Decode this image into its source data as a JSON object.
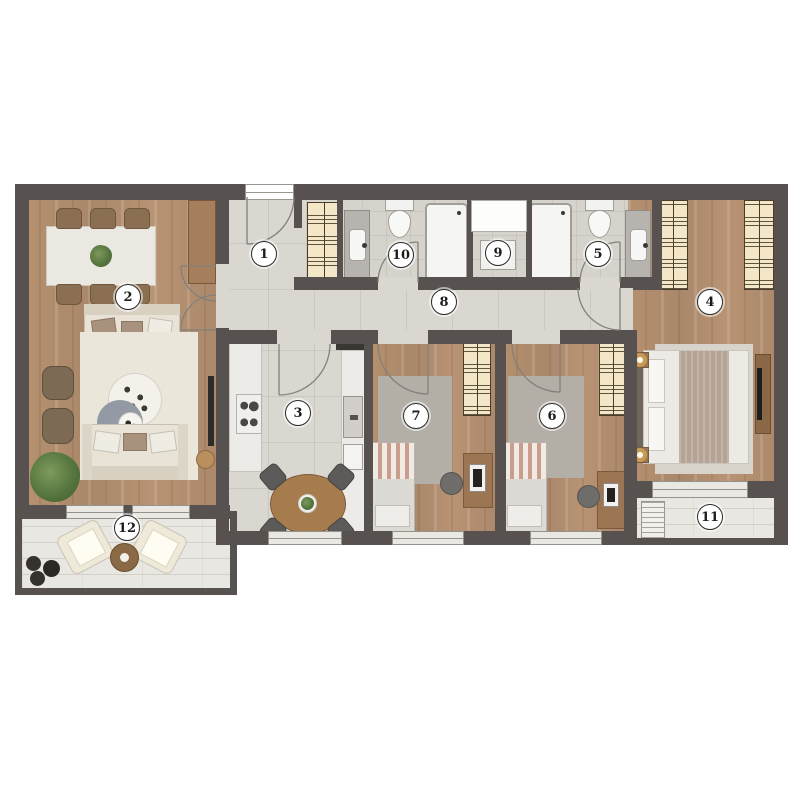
{
  "plan": {
    "type": "apartment-floor-plan",
    "background": "#ffffff"
  },
  "palette": {
    "wall": "#57524f",
    "wood_floor": "#b08c6d",
    "tile_floor": "#dad7d1",
    "balcony_floor": "#e9e7e1",
    "fixture_white": "#f5f5f3",
    "wardrobe_cream": "#f3e7c8",
    "furniture_wood": "#a67c4f",
    "rug_gray": "#939aa3",
    "plant_green": "#56763f",
    "badge_border": "#2c2b29"
  },
  "rooms": [
    {
      "label": "1",
      "name": "entrance"
    },
    {
      "label": "2",
      "name": "living-dining-room"
    },
    {
      "label": "3",
      "name": "kitchen"
    },
    {
      "label": "4",
      "name": "master-bedroom"
    },
    {
      "label": "5",
      "name": "ensuite-bathroom"
    },
    {
      "label": "6",
      "name": "bedroom-2"
    },
    {
      "label": "7",
      "name": "bedroom-1"
    },
    {
      "label": "8",
      "name": "hallway"
    },
    {
      "label": "9",
      "name": "utility-shaft"
    },
    {
      "label": "10",
      "name": "bathroom"
    },
    {
      "label": "11",
      "name": "balcony-bedroom"
    },
    {
      "label": "12",
      "name": "balcony-living"
    }
  ]
}
